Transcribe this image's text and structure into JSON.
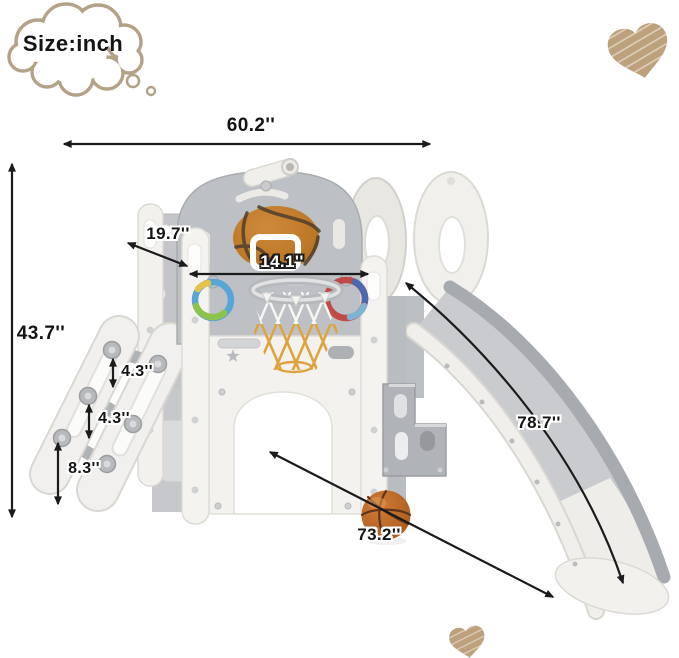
{
  "bubble": {
    "label": "Size:inch"
  },
  "dimensions": {
    "top_width": "60.2''",
    "overall_height": "43.7''",
    "panel_depth": "19.7''",
    "backboard_width": "14.1''",
    "ladder_step_gap_top": "4.3''",
    "ladder_step_gap_middle": "4.3''",
    "ladder_bottom_step_height": "8.3''",
    "slide_length": "78.7''",
    "base_diagonal_length": "73.2''"
  },
  "colors": {
    "dimension_arrow": "#1b1b1b",
    "cloud_outline": "#b3a288",
    "heart_scribble": "#bda17c",
    "structure_white": "#f3f1ed",
    "panel_gray": "#bdc0c4",
    "slide_surface": "#c9cbcf",
    "basketball_orange": "#c0712e",
    "net_orange": "#dfa33e",
    "ring_blue": "#58a5d7",
    "ring_green": "#8bc34c",
    "ring_red": "#c14a44"
  },
  "icons": {
    "thought_bubble": "cloud-thought-bubble-icon",
    "heart_top_right": "scribble-heart-icon",
    "heart_bottom": "scribble-heart-icon",
    "ball": "basketball-icon"
  }
}
